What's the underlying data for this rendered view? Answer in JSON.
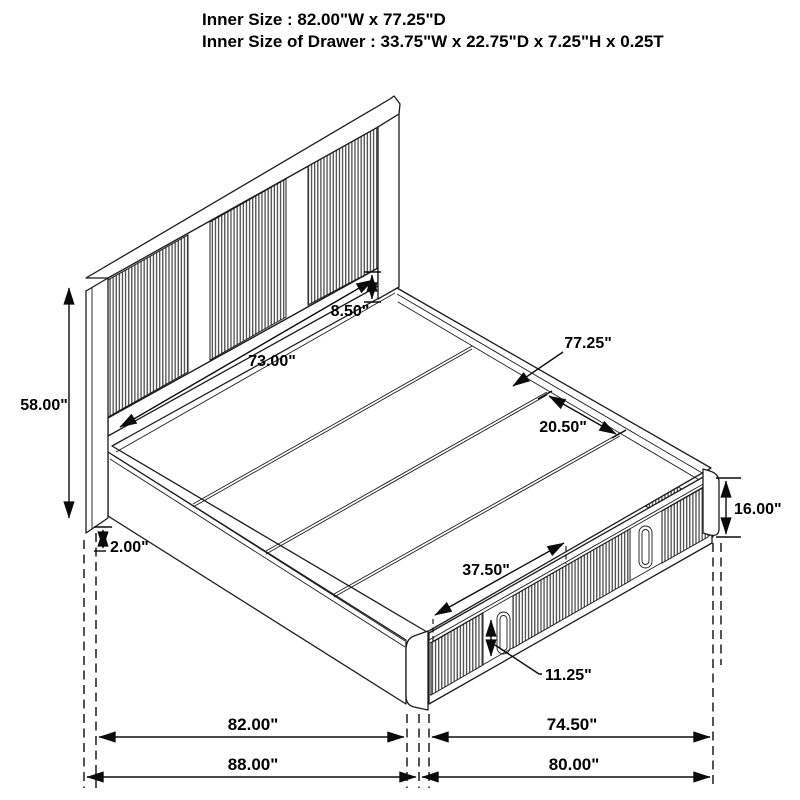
{
  "title": {
    "line1": "Inner Size : 82.00\"W x 77.25\"D",
    "line2": "Inner Size of Drawer : 33.75\"W x 22.75\"D x 7.25\"H x 0.25T"
  },
  "diagram": {
    "type": "isometric-storage-bed-dimension-drawing",
    "style": {
      "line_color": "#1c1c1c",
      "background": "#ffffff",
      "slat_color": "#555555"
    },
    "labels": {
      "headboard_height": "58.00\"",
      "headboard_opening_width": "73.00\"",
      "panel_to_deck_gap": "8.50\"",
      "deck_depth": "77.25\"",
      "plank_depth": "20.50\"",
      "platform_height": "16.00\"",
      "leg_clearance": "2.00\"",
      "drawer_opening_width": "37.50\"",
      "drawer_front_height": "11.25\"",
      "inner_width": "82.00\"",
      "inner_depth": "74.50\"",
      "overall_width": "88.00\"",
      "overall_depth": "80.00\""
    }
  }
}
